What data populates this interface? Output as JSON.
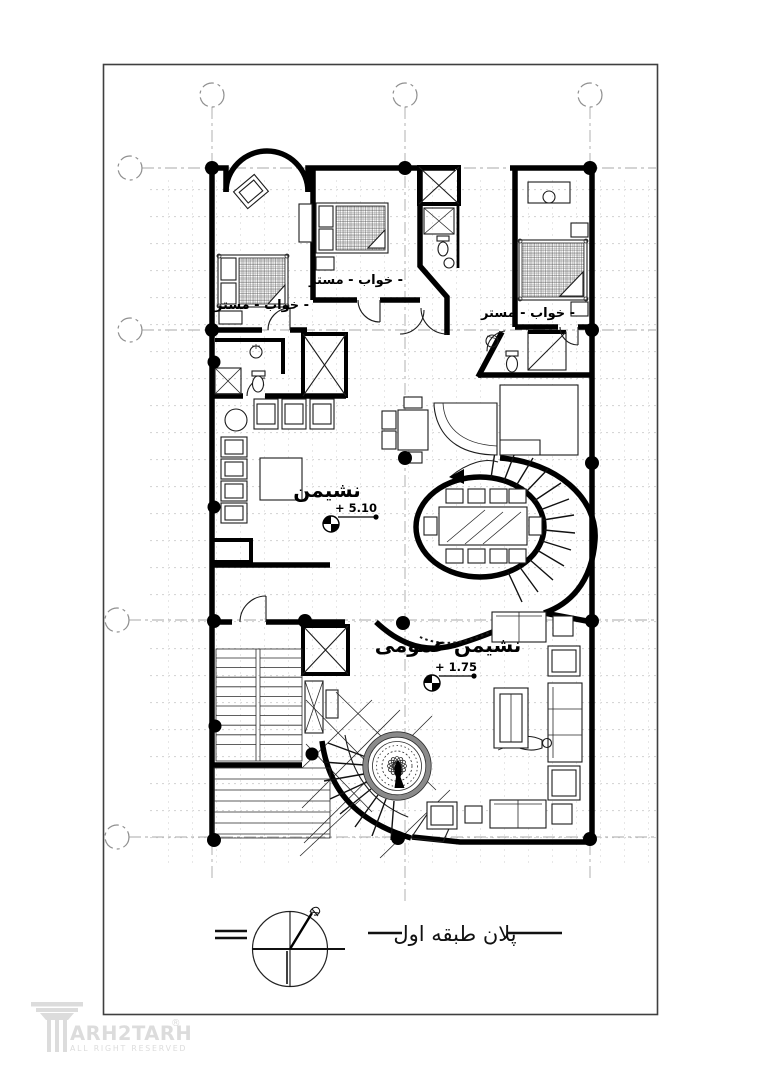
{
  "page": {
    "background": "#ffffff",
    "border_color": "#3f3f3f"
  },
  "colors": {
    "ink": "#000000",
    "grid_line": "#a8a8a8",
    "texture": "#d6d6d6",
    "watermark": "#dcdcdc"
  },
  "plan": {
    "rooms": [
      {
        "id": "bedroom-left",
        "label": "خواب - مستر -"
      },
      {
        "id": "bedroom-middle",
        "label": "خواب - مستر -"
      },
      {
        "id": "bedroom-right",
        "label": "خواب - مستر -"
      },
      {
        "id": "living-room",
        "label": "نشیمن"
      },
      {
        "id": "family-living-room",
        "label": "نشیمن عمومی"
      }
    ],
    "levels": [
      {
        "id": "living-level",
        "label": "+ 5.10"
      },
      {
        "id": "family-level",
        "label": "+ 1.75"
      }
    ]
  },
  "caption": {
    "title": "پلان طبقه اول"
  },
  "watermark": {
    "brand": "ARH2TARH",
    "registered": "®",
    "tagline": "ALL RIGHT RESERVED"
  },
  "icons": {
    "compass": "north-compass-icon",
    "level_marker": "elevation-level-icon",
    "logo": "column-capital-icon"
  }
}
